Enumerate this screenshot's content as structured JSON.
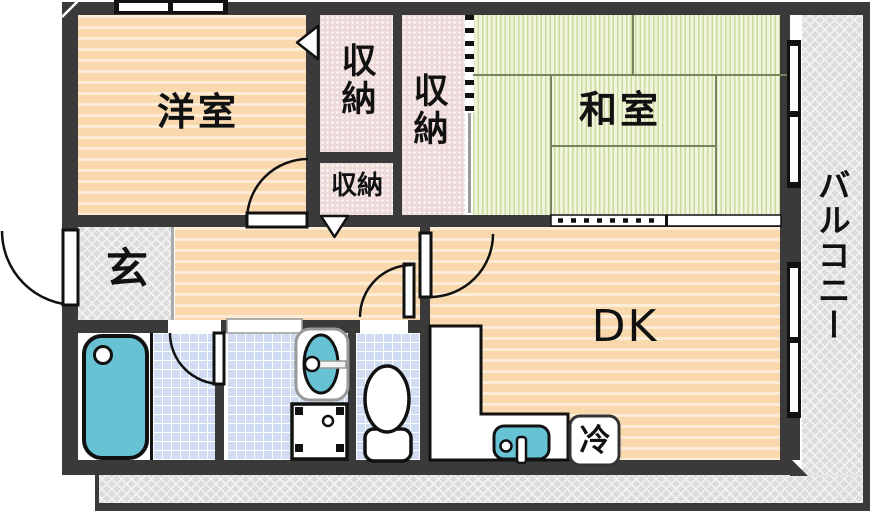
{
  "plan": {
    "labels": {
      "western_room": "洋室",
      "japanese_room": "和室",
      "dining_kitchen": "DK",
      "entrance": "玄",
      "balcony": "バルコニー",
      "closet_west": "収納",
      "closet_east": "収納",
      "closet_small": "収納",
      "refrigerator": "冷"
    },
    "colors": {
      "wall": "#3a3a3a",
      "wood_floor": "#f8d8ac",
      "wood_stripe": "#fcecd8",
      "tatami": "#f1f5de",
      "tatami_stripe": "#c9db9d",
      "closet": "#eed9d9",
      "tile": "#cfdcf2",
      "water_fixture": "#67c2d4",
      "exterior": "#dcdcdc"
    },
    "fixtures": [
      "bathtub",
      "washbasin",
      "washing-machine-pan",
      "toilet",
      "kitchen-counter",
      "kitchen-sink",
      "refrigerator"
    ]
  }
}
